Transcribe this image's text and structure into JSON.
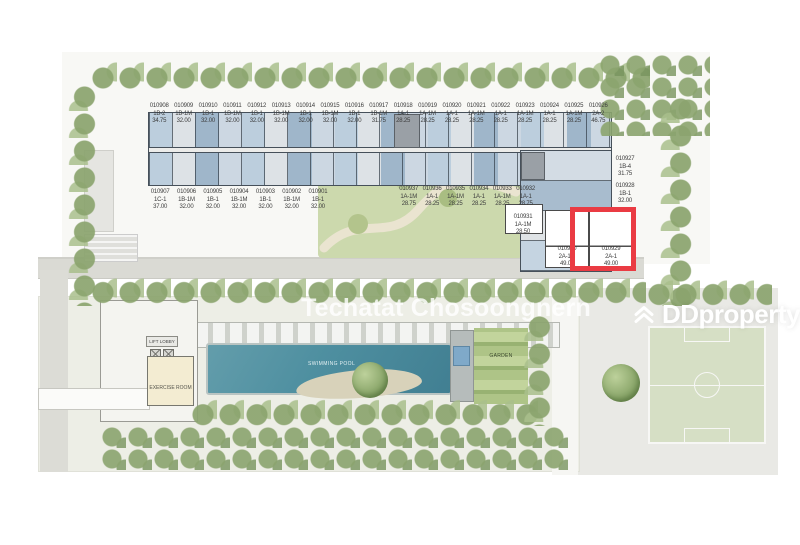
{
  "page": {
    "watermark": "Techatat Chosoongnern",
    "brand": "DDproperty"
  },
  "highlight": {
    "unit_no": "010929",
    "color": "#ea3b43"
  },
  "amenities": {
    "swimming_pool": "SWIMMING POOL",
    "exercise_room": "EXERCISE ROOM",
    "lift_lobby": "LIFT LOBBY",
    "garden": "GARDEN"
  },
  "units": {
    "top_row": [
      {
        "no": "010908",
        "type": "1B-2",
        "size": "34.75"
      },
      {
        "no": "010909",
        "type": "1B-1M",
        "size": "32.00"
      },
      {
        "no": "010910",
        "type": "1B-1",
        "size": "32.00"
      },
      {
        "no": "010911",
        "type": "1B-1M",
        "size": "32.00"
      },
      {
        "no": "010912",
        "type": "1B-1",
        "size": "32.00"
      },
      {
        "no": "010913",
        "type": "1B-1M",
        "size": "32.00"
      },
      {
        "no": "010914",
        "type": "1B-1",
        "size": "32.00"
      },
      {
        "no": "010915",
        "type": "1B-1M",
        "size": "32.00"
      },
      {
        "no": "010916",
        "type": "1B-1",
        "size": "32.00"
      },
      {
        "no": "010917",
        "type": "1B-1M",
        "size": "31.75"
      },
      {
        "no": "010918",
        "type": "1A-1",
        "size": "28.25"
      },
      {
        "no": "010919",
        "type": "1A-1M",
        "size": "28.25"
      },
      {
        "no": "010920",
        "type": "1A-1",
        "size": "28.25"
      },
      {
        "no": "010921",
        "type": "1A-1M",
        "size": "28.25"
      },
      {
        "no": "010922",
        "type": "1A-1",
        "size": "28.25"
      },
      {
        "no": "010923",
        "type": "1A-1M",
        "size": "28.25"
      },
      {
        "no": "010924",
        "type": "1A-1",
        "size": "28.25"
      },
      {
        "no": "010925",
        "type": "1A-1M",
        "size": "28.25"
      },
      {
        "no": "010926",
        "type": "2A-2",
        "size": "46.75"
      }
    ],
    "mid_west": [
      {
        "no": "010907",
        "type": "1C-1",
        "size": "37.00"
      },
      {
        "no": "010906",
        "type": "1B-1M",
        "size": "32.00"
      },
      {
        "no": "010905",
        "type": "1B-1",
        "size": "32.00"
      },
      {
        "no": "010904",
        "type": "1B-1M",
        "size": "32.00"
      },
      {
        "no": "010903",
        "type": "1B-1",
        "size": "32.00"
      },
      {
        "no": "010902",
        "type": "1B-1M",
        "size": "32.00"
      },
      {
        "no": "010901",
        "type": "1B-1",
        "size": "32.00"
      }
    ],
    "mid_east": [
      {
        "no": "010937",
        "type": "1A-1M",
        "size": "28.75"
      },
      {
        "no": "010936",
        "type": "1A-1",
        "size": "28.25"
      },
      {
        "no": "010935",
        "type": "1A-1M",
        "size": "28.25"
      },
      {
        "no": "010934",
        "type": "1A-1",
        "size": "28.25"
      },
      {
        "no": "010933",
        "type": "1A-1M",
        "size": "28.25"
      },
      {
        "no": "010932",
        "type": "1A-1",
        "size": "28.75"
      }
    ],
    "right_col": [
      {
        "no": "010927",
        "type": "1B-4",
        "size": "31.75"
      },
      {
        "no": "010928",
        "type": "1B-1",
        "size": "32.00"
      }
    ],
    "corner": [
      {
        "no": "010931",
        "type": "1A-1M",
        "size": "28.50"
      },
      {
        "no": "010930",
        "type": "2A-1M",
        "size": "49.00"
      },
      {
        "no": "010929",
        "type": "2A-1",
        "size": "49.00"
      }
    ]
  }
}
